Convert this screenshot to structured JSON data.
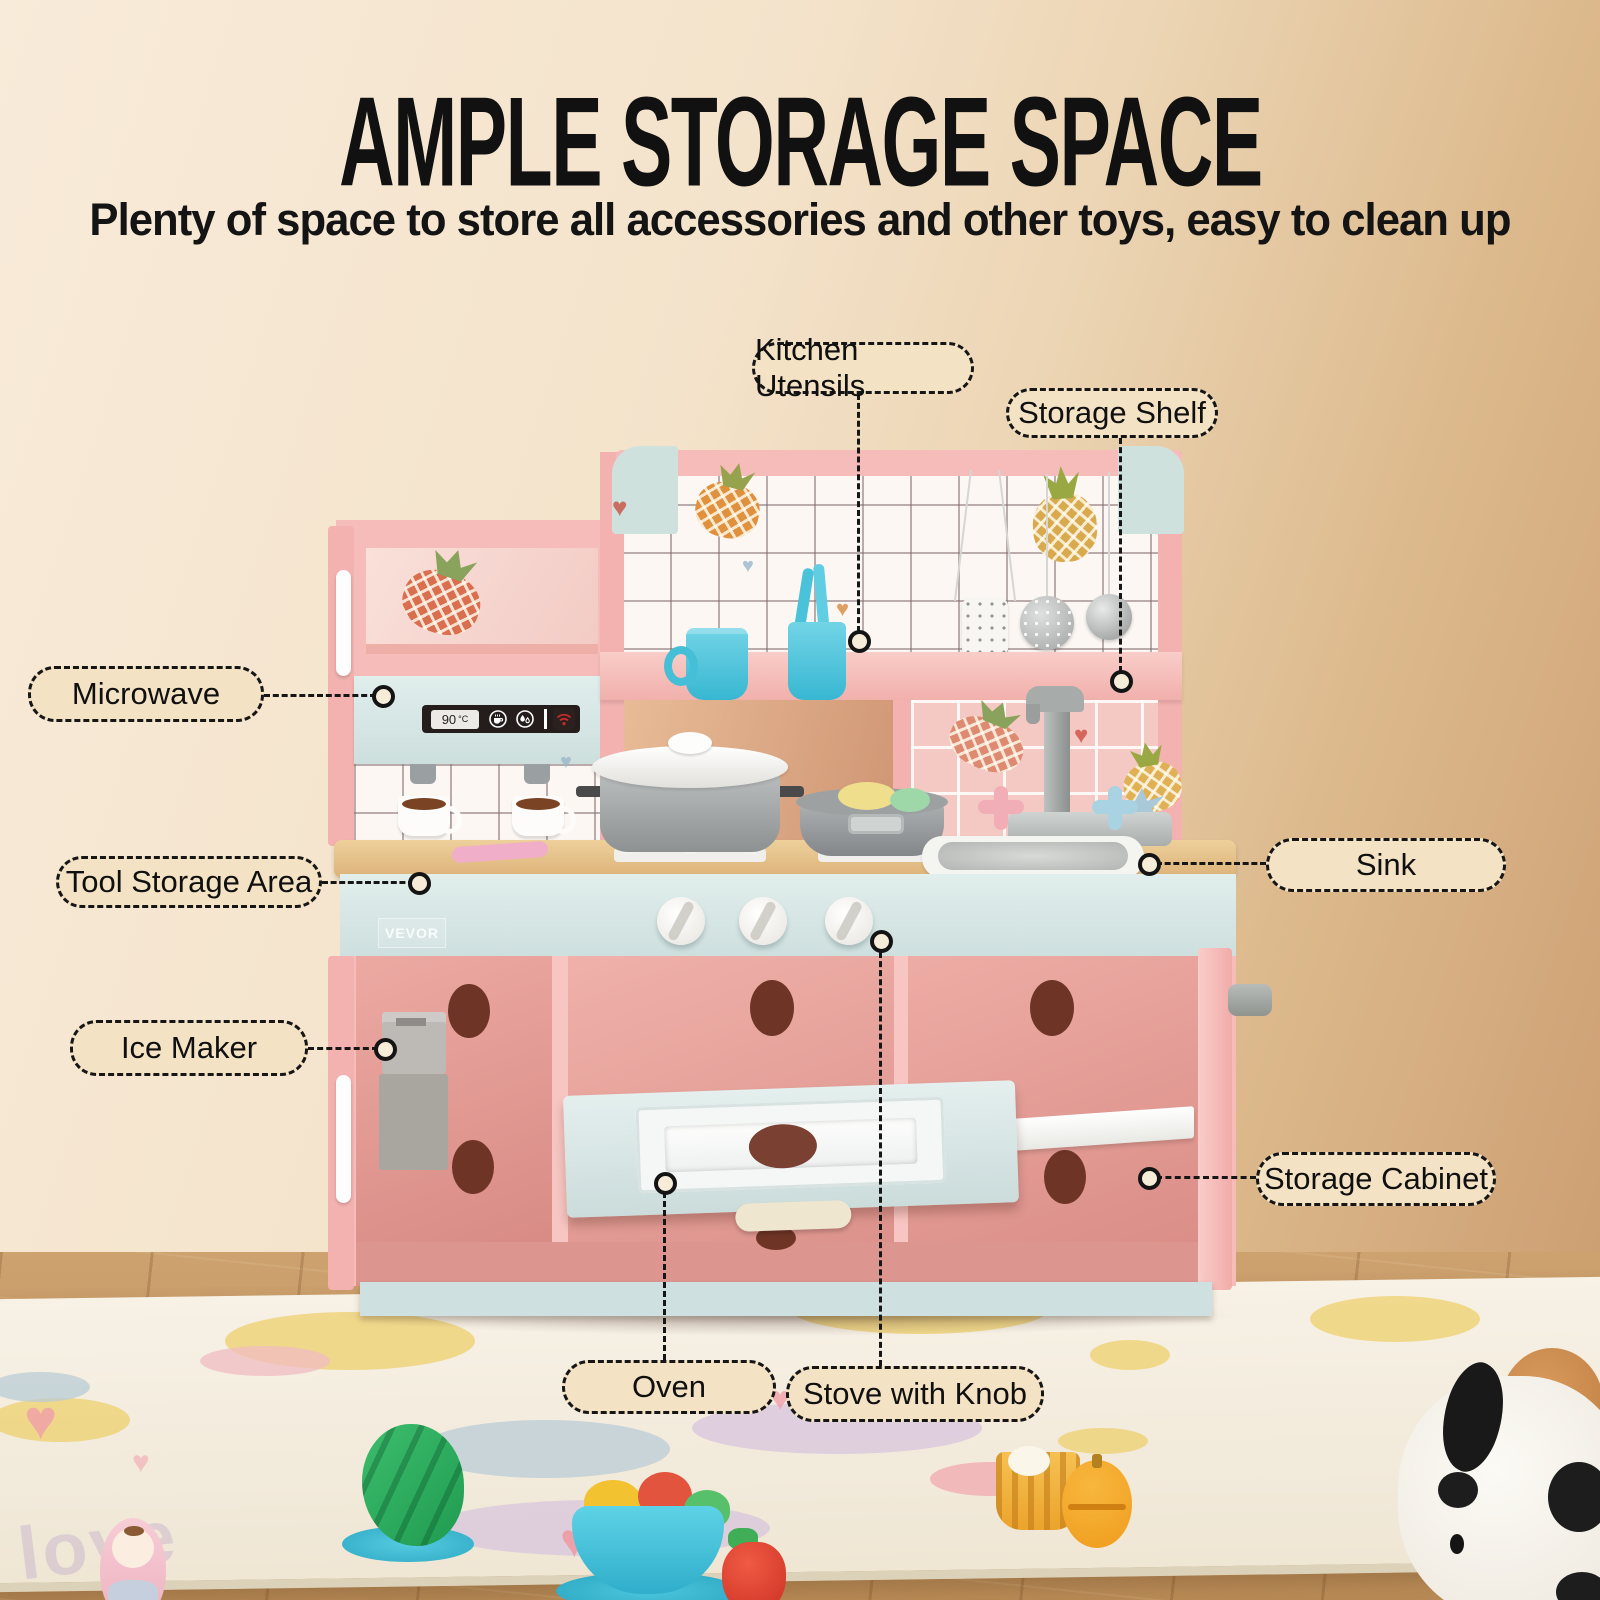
{
  "header": {
    "title": "AMPLE STORAGE SPACE",
    "subtitle": "Plenty of space to store all accessories and other toys, easy to clean up"
  },
  "callouts": {
    "kitchen_utensils": "Kitchen Utensils",
    "storage_shelf": "Storage Shelf",
    "microwave": "Microwave",
    "tool_storage_area": "Tool Storage Area",
    "sink": "Sink",
    "ice_maker": "Ice Maker",
    "storage_cabinet": "Storage Cabinet",
    "oven": "Oven",
    "stove_with_knob": "Stove with Knob"
  },
  "kitchen": {
    "brand": "VEVOR",
    "display_temp": "90",
    "display_unit": "°C",
    "rug_text": "love"
  },
  "colors": {
    "label_bg": "#f4e2c4",
    "kitchen_pink": "#f6bcba",
    "kitchen_mint": "#cfe1dd",
    "panel_blue": "#d6e4e3",
    "counter_wood": "#e3bc84",
    "cup_blue": "#45c1da",
    "display_red": "#c62a2a"
  }
}
